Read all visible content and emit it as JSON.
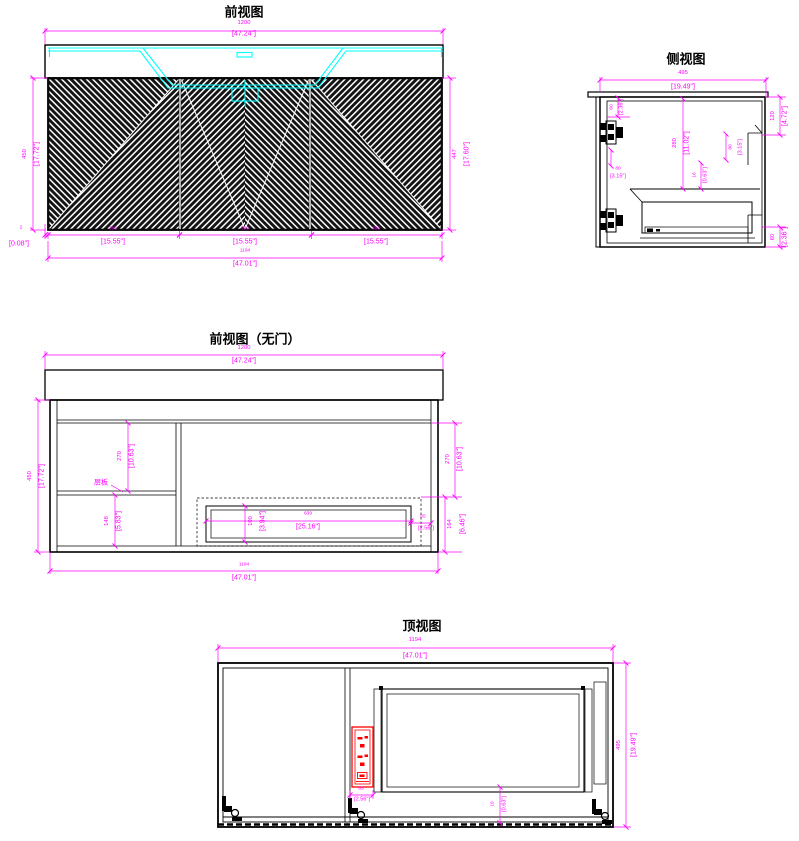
{
  "colors": {
    "bg": "#ffffff",
    "line": "#000000",
    "dim": "#ff00ff",
    "sink": "#00ffff",
    "outlet": "#ff0000",
    "door": "#141414"
  },
  "views": {
    "front": {
      "title": "前视图",
      "dims": {
        "top": {
          "mm": "1200",
          "in": "[47.24\"]"
        },
        "left": {
          "mm": "450",
          "in": "[17.72\"]"
        },
        "right": {
          "mm": "447",
          "in": "[17.60\"]"
        },
        "toe": {
          "mm": "2",
          "in": "[0.08\"]"
        },
        "door1": {
          "mm": "395",
          "in": "[15.55\"]"
        },
        "door2": {
          "mm": "395",
          "in": "[15.55\"]"
        },
        "door3": {
          "mm": "395",
          "in": "[15.55\"]"
        },
        "total": {
          "mm": "1194",
          "in": "[47.01\"]"
        }
      }
    },
    "side": {
      "title": "侧视图",
      "dims": {
        "depth": {
          "mm": "495",
          "in": "[19.49\"]"
        },
        "top_gap": {
          "mm": "60",
          "in": "[2.36\"]"
        },
        "left_gap": {
          "mm": "80",
          "in": "[3.15\"]"
        },
        "inner_height": {
          "mm": "280",
          "in": "[11.02\"]"
        },
        "board": {
          "mm": "16",
          "in": "[0.63\"]"
        },
        "back_rail": {
          "mm": "80",
          "in": "[3.15\"]"
        },
        "right_top": {
          "mm": "120",
          "in": "[4.72\"]"
        },
        "right_bottom": {
          "mm": "60",
          "in": "[2.36\"]"
        }
      }
    },
    "nodoor": {
      "title": "前视图（无门）",
      "shelf_label": "层板",
      "dims": {
        "top": {
          "mm": "1200",
          "in": "[47.24\"]"
        },
        "left": {
          "mm": "450",
          "in": "[17.72\"]"
        },
        "upper": {
          "mm": "270",
          "in": "[10.63\"]"
        },
        "lower": {
          "mm": "148",
          "in": "[5.83\"]"
        },
        "right_upper": {
          "mm": "270",
          "in": "[10.63\"]"
        },
        "right_lower": {
          "mm": "164",
          "in": "[6.46\"]"
        },
        "gap": {
          "mm": "65",
          "in": "[2.56\"]"
        },
        "drawer_h": {
          "mm": "100",
          "in": "[3.94\"]"
        },
        "drawer_w": {
          "mm": "639",
          "in": "[25.16\"]"
        },
        "total": {
          "mm": "1194",
          "in": "[47.01\"]"
        }
      }
    },
    "top": {
      "title": "顶视图",
      "dims": {
        "width": {
          "mm": "1194",
          "in": "[47.01\"]"
        },
        "depth": {
          "mm": "495",
          "in": "[19.49\"]"
        },
        "outlet": {
          "mm": "65",
          "in": "[2.56\"]"
        },
        "back": {
          "mm": "16",
          "in": "[0.63\"]"
        }
      }
    }
  }
}
